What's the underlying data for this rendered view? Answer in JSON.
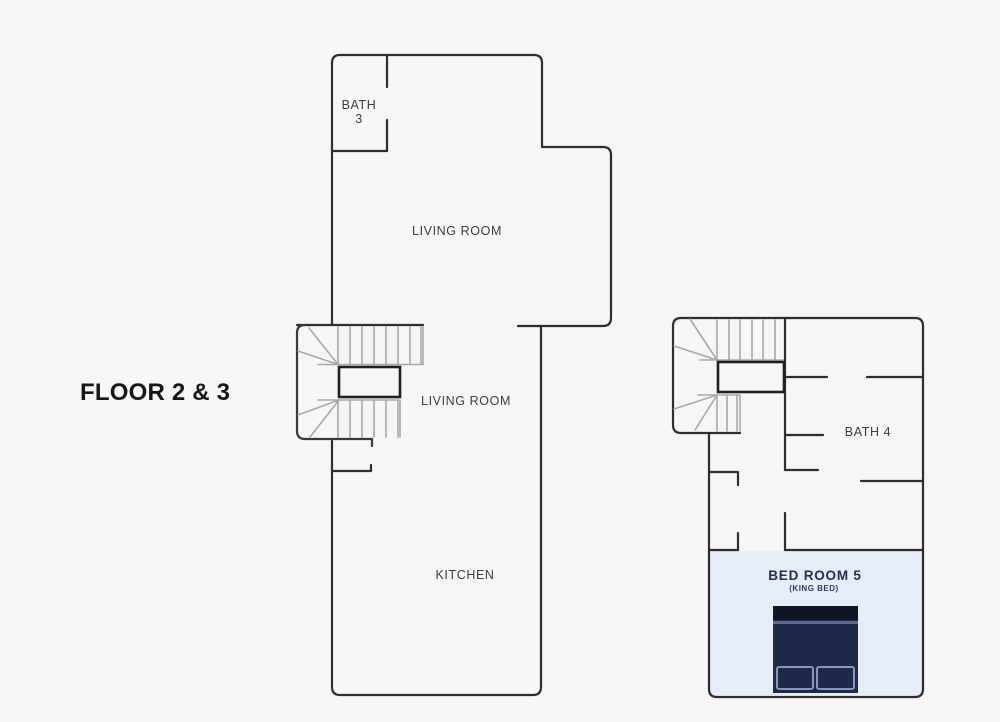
{
  "floorplan": {
    "title": "FLOOR 2 & 3",
    "left_unit": {
      "bath": {
        "line1": "BATH",
        "line2": "3"
      },
      "living_upper": "LIVING ROOM",
      "living_mid": "LIVING ROOM",
      "kitchen": "KITCHEN"
    },
    "right_unit": {
      "bath": "BATH 4",
      "bedroom": {
        "name": "BED ROOM 5",
        "subtitle": "(KING BED)"
      }
    },
    "colors": {
      "background": "#f7f6f4",
      "wall": "#2e2e2e",
      "stair_tread": "#a8a8a8",
      "stair_landing": "#1f1f1f",
      "bedroom_highlight": "#e6edf8",
      "bed_body": "#1d2946",
      "bed_headboard": "#0f1626",
      "bed_separator": "#5b6a8e",
      "pillow_border": "#8a96b8",
      "room_label": "#3d3d3d",
      "bedroom_label": "#22304f",
      "title_color": "#161616"
    }
  }
}
